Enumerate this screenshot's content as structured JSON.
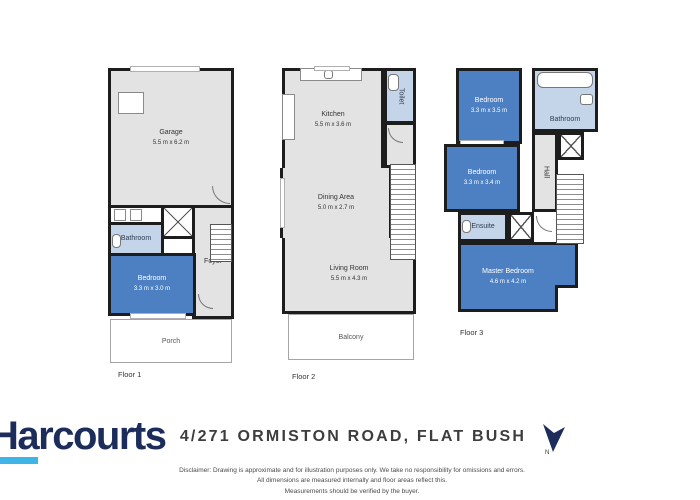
{
  "colors": {
    "wall": "#1d1d1d",
    "room_gray": "#e3e3e3",
    "bedroom_blue": "#4d80c2",
    "bath_blue": "#c4d4e9",
    "logo_navy": "#1c2d5c",
    "logo_cyan": "#3fb5e7",
    "address_text": "#3d3d3d"
  },
  "floor1": {
    "label": "Floor 1",
    "garage": {
      "name": "Garage",
      "dims": "5.5 m x 6.2 m"
    },
    "bathroom": {
      "name": "Bathroom"
    },
    "bedroom": {
      "name": "Bedroom",
      "dims": "3.3 m x 3.0 m"
    },
    "foyer": {
      "name": "Foyer"
    },
    "porch": {
      "name": "Porch"
    }
  },
  "floor2": {
    "label": "Floor 2",
    "kitchen": {
      "name": "Kitchen",
      "dims": "5.5 m x 3.6 m"
    },
    "toilet": {
      "name": "Toilet"
    },
    "dining": {
      "name": "Dining Area",
      "dims": "5.0 m x 2.7 m"
    },
    "living": {
      "name": "Living Room",
      "dims": "5.5 m x 4.3 m"
    },
    "balcony": {
      "name": "Balcony"
    }
  },
  "floor3": {
    "label": "Floor 3",
    "bedroom1": {
      "name": "Bedroom",
      "dims": "3.3 m x 3.5 m"
    },
    "bathroom": {
      "name": "Bathroom"
    },
    "bedroom2": {
      "name": "Bedroom",
      "dims": "3.3 m x 3.4 m"
    },
    "ensuite": {
      "name": "Ensuite"
    },
    "hall": {
      "name": "Hall"
    },
    "master": {
      "name": "Master Bedroom",
      "dims": "4.6 m x 4.2 m"
    }
  },
  "footer": {
    "brand": "Harcourts",
    "address": "4/271 ORMISTON ROAD, FLAT BUSH",
    "north_icon": "north-arrow",
    "north_label": "N",
    "disclaimer_lines": [
      "Disclaimer: Drawing is approximate and for illustration purposes only. We take no responsibility for omissions and errors.",
      "All dimensions are measured internally and floor areas reflect this.",
      "Measurements should be verified by the buyer."
    ]
  }
}
